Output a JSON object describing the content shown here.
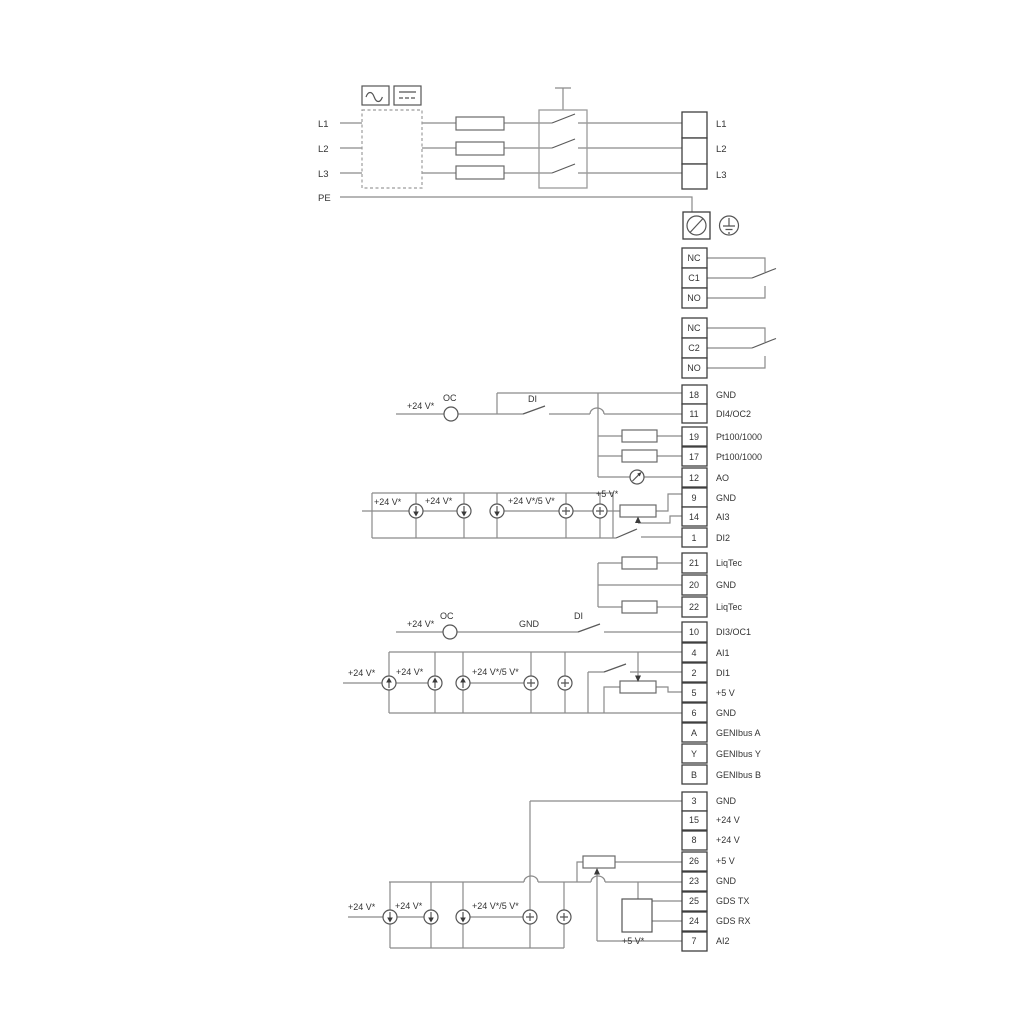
{
  "power": {
    "in": [
      "L1",
      "L2",
      "L3",
      "PE"
    ],
    "out": [
      "L1",
      "L2",
      "L3"
    ]
  },
  "relays": [
    [
      "NC",
      "C1",
      "NO"
    ],
    [
      "NC",
      "C2",
      "NO"
    ]
  ],
  "groups": {
    "g1": [
      {
        "id": "18",
        "label": "GND"
      },
      {
        "id": "11",
        "label": "DI4/OC2"
      },
      {
        "id": "19",
        "label": "Pt100/1000"
      },
      {
        "id": "17",
        "label": "Pt100/1000"
      },
      {
        "id": "12",
        "label": "AO"
      },
      {
        "id": "9",
        "label": "GND"
      },
      {
        "id": "14",
        "label": "AI3"
      },
      {
        "id": "1",
        "label": "DI2"
      }
    ],
    "g2": [
      {
        "id": "21",
        "label": "LiqTec"
      },
      {
        "id": "20",
        "label": "GND"
      },
      {
        "id": "22",
        "label": "LiqTec"
      }
    ],
    "g3": [
      {
        "id": "10",
        "label": "DI3/OC1"
      },
      {
        "id": "4",
        "label": "AI1"
      },
      {
        "id": "2",
        "label": "DI1"
      },
      {
        "id": "5",
        "label": "+5 V"
      },
      {
        "id": "6",
        "label": "GND"
      },
      {
        "id": "A",
        "label": "GENIbus A"
      },
      {
        "id": "Y",
        "label": "GENIbus Y"
      },
      {
        "id": "B",
        "label": "GENIbus B"
      }
    ],
    "g4": [
      {
        "id": "3",
        "label": "GND"
      },
      {
        "id": "15",
        "label": "+24 V"
      },
      {
        "id": "8",
        "label": "+24 V"
      },
      {
        "id": "26",
        "label": "+5 V"
      },
      {
        "id": "23",
        "label": "GND"
      },
      {
        "id": "25",
        "label": "GDS TX"
      },
      {
        "id": "24",
        "label": "GDS RX"
      },
      {
        "id": "7",
        "label": "AI2"
      }
    ]
  },
  "labels": {
    "plus24": "+24 V*",
    "plus24or5": "+24 V*/5 V*",
    "plus5": "+5 V*",
    "oc": "OC",
    "di": "DI",
    "gnd": "GND"
  },
  "colors": {
    "wire": "#8a8a8a",
    "outline": "#454545",
    "text": "#333333"
  }
}
